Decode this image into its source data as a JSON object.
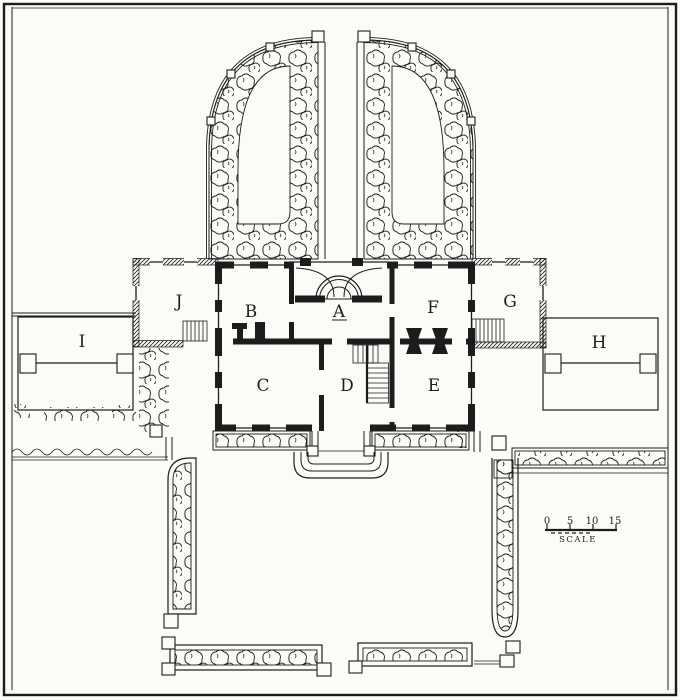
{
  "drawing": {
    "rooms": [
      {
        "label": "A"
      },
      {
        "label": "B"
      },
      {
        "label": "C"
      },
      {
        "label": "D"
      },
      {
        "label": "E"
      },
      {
        "label": "F"
      },
      {
        "label": "G"
      },
      {
        "label": "H"
      },
      {
        "label": "I"
      },
      {
        "label": "J"
      }
    ],
    "scale_bar": {
      "ticks": [
        "0",
        "5",
        "10",
        "15"
      ],
      "label": "SCALE"
    },
    "colors": {
      "ink": "#1c1c1c",
      "paper": "#fbfbf8"
    }
  }
}
